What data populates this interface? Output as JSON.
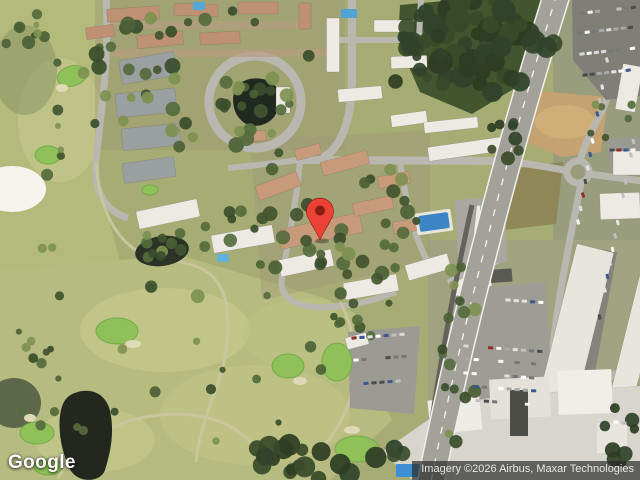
{
  "branding": {
    "logo_text": "Google"
  },
  "attribution": {
    "text": "Imagery ©2026 Airbus, Maxar Technologies"
  },
  "marker": {
    "color": "#EA4335",
    "dot_color": "#8A1B0F"
  }
}
